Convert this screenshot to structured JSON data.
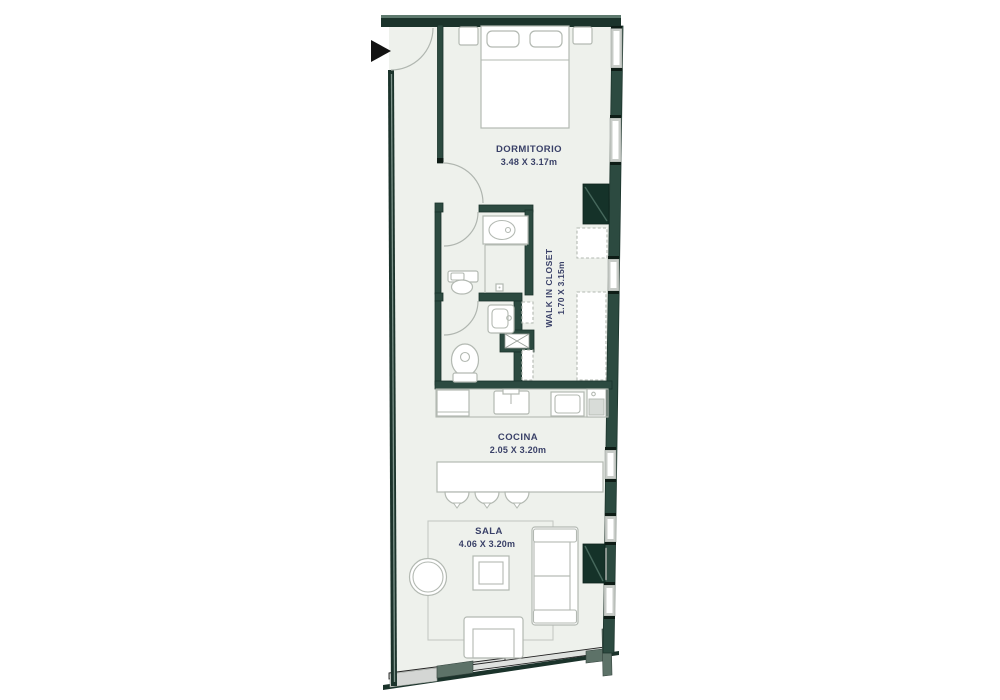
{
  "plan": {
    "title": "apartment-floor-plan",
    "rooms": {
      "dormitorio": {
        "name": "DORMITORIO",
        "dims": "3.48 X 3.17m"
      },
      "walk_in_closet": {
        "name": "WALK IN CLOSET",
        "dims": "1.70 X 3.15m"
      },
      "cocina": {
        "name": "COCINA",
        "dims": "2.05 X 3.20m"
      },
      "sala": {
        "name": "SALA",
        "dims": "4.06 X 3.20m"
      }
    },
    "icons": {
      "entrance_arrow": "black triangle entry marker",
      "door_arc": "door swing quarter-circle",
      "bed": "double bed with pillows",
      "nightstand": "bedside table",
      "ac_unit": "dark green equipment box",
      "closet_shelf": "dashed wardrobe module",
      "vanity_sink": "bathroom counter with oval basin",
      "shower": "shower area with head",
      "toilet": "toilet with tank",
      "hand_sink": "small square basin",
      "column": "structural column with X",
      "fridge": "refrigerator",
      "kitchen_sink": "sink with faucet",
      "stove": "cooktop",
      "washer": "laundry machine",
      "island": "kitchen bar island",
      "stool": "bar stool semicircle",
      "rug": "area rug",
      "sofa": "three-seat sofa",
      "armchair": "single armchair",
      "coffee_table": "square coffee table",
      "side_table": "round side table",
      "tv_unit": "dark green media box",
      "window": "gray window segment",
      "sliding_door": "angled balcony glazing"
    },
    "colors": {
      "wall": "#2c4a40",
      "wall_outer": "#1b332b",
      "cap": "#0e1c16",
      "accent_box": "#153229",
      "floor": "#eef1ec",
      "furniture_line": "#b3b9b2",
      "window_frame": "#c8ccc8",
      "label_text": "#3a4168",
      "arrow": "#121212",
      "glass": "#dfe2df",
      "mullion": "#5d7268",
      "door_arc": "#b0b6b0"
    }
  }
}
